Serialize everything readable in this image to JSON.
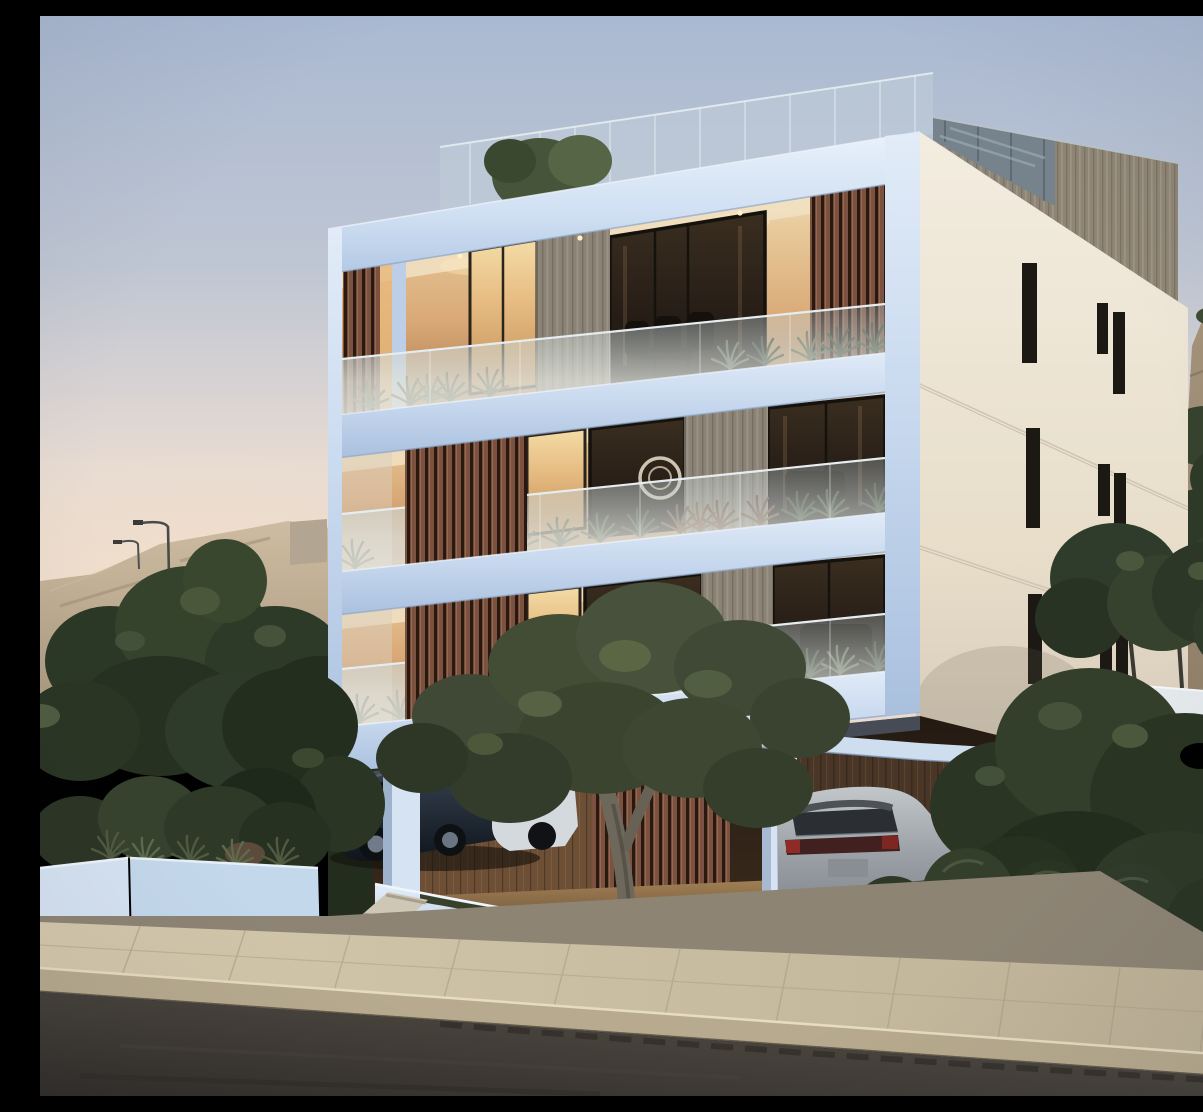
{
  "meta": {
    "type": "3d architectural rendering",
    "setting": "modern residential apartment building at dusk",
    "description": "Photorealistic dusk rendering of a modern three-storey white apartment building with brown timber slat screens, glass balcony balustrades planted with greenery, warm lit interiors, a rooftop glass terrace with a grey timber-clad roof box, covered ground-level parking containing a dark sedan and a silver SUV, a large olive tree in a curved white planter, landscaped white garden walls with steps and shrubs, a paved sidewalk and a dark asphalt road in the foreground, and arid scrub hills with street lamps in the background."
  },
  "scene": {
    "objects": [
      "dusk sky",
      "sandy hill with street lamps",
      "rocky hill with shrubs",
      "apartment building front facade",
      "cream side wall with slit windows",
      "rooftop glass balustrade",
      "grey timber roof box",
      "timber slat screens",
      "glass balcony balustrades",
      "balcony plants",
      "balcony chairs",
      "wall art circle",
      "couch silhouettes",
      "recessed downlights",
      "carport with timber walls",
      "dark sedan",
      "white car",
      "silver suv",
      "white columns",
      "olive tree",
      "curved white planter",
      "garden steps",
      "white garden walls",
      "round bushes on mulch",
      "paved sidewalk with curb",
      "asphalt road"
    ]
  },
  "palette": {
    "sky-top": "#aab9d2",
    "sky-horizon": "#e7dbd2",
    "facade-white": "#c7d8ee",
    "facade-shadow": "#a9c0de",
    "cream-wall": "#e7ddc9",
    "timber-brown": "#7b5140",
    "timber-grey": "#8b8376",
    "glass-balustrade": "#cdd8d8",
    "interior-glow": "#e2b986",
    "window-frame": "#1c1915",
    "foliage": "#3a4630",
    "foliage-light": "#5b684a",
    "hill-sand": "#b7a68a",
    "sedan-navy": "#222b36",
    "suv-silver": "#9ba1a6",
    "planter-white": "#d6e3f2",
    "sidewalk": "#cdc1a6",
    "curb": "#b7aa8e",
    "road-asphalt": "#3b3631",
    "mulch": "#ac936f"
  }
}
